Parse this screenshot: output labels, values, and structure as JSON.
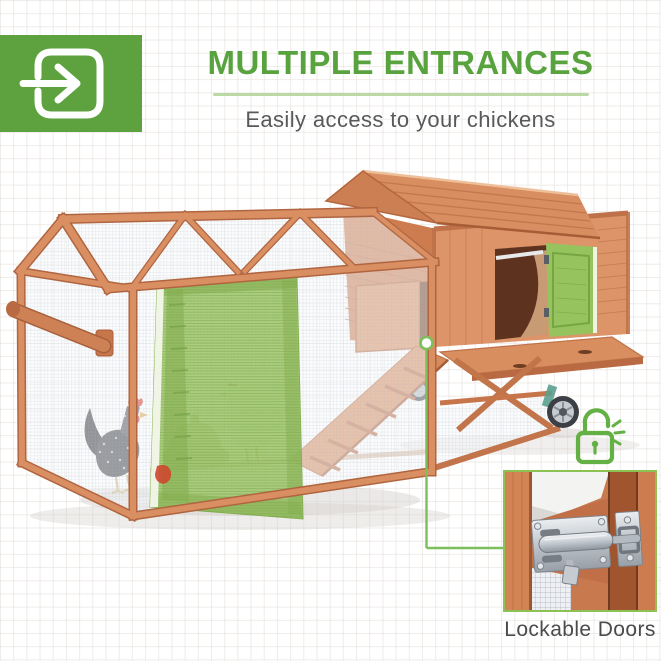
{
  "header": {
    "icon_name": "door-enter-arrow-icon",
    "title": "MULTIPLE ENTRANCES",
    "subtitle": "Easily access to your chickens"
  },
  "photo": {
    "alt": "Wooden chicken coop with mesh run, rooster and hen inside, ramp, pull-out tray and wheels; the run door and the hen-house side door are highlighted in green"
  },
  "callout": {
    "icon_name": "unlocked-padlock-icon",
    "caption": "Lockable Doors"
  },
  "colors": {
    "accent-green": "#58a33e",
    "icon-plate-green": "#5ea13f",
    "divider-green": "#bcd8a5",
    "subtitle-gray": "#58595b",
    "caption-gray": "#4a4b4d",
    "highlight-green": "#97c35f",
    "callout-green": "#63b045",
    "connector-green": "#7cbf5b",
    "inset-border-green": "#8cc153"
  }
}
